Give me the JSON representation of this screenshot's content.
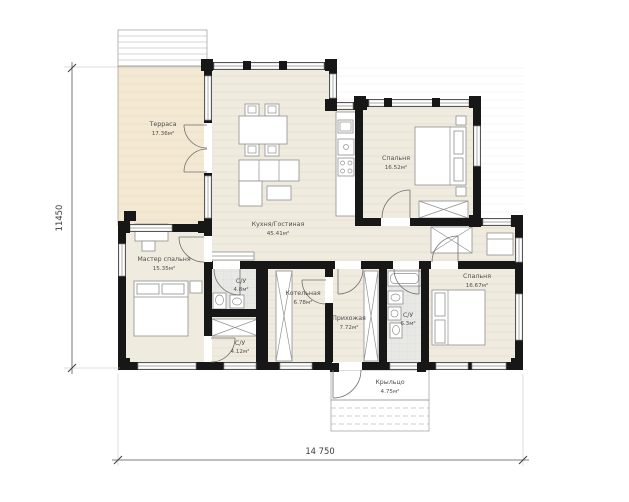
{
  "plan": {
    "title": "single-storey house floor plan",
    "rooms": [
      {
        "id": "terrace",
        "name": "Терраса",
        "area": "17.36м²"
      },
      {
        "id": "kitchen_living",
        "name": "Кухня/Гостиная",
        "area": "45.41м²"
      },
      {
        "id": "bedroom_top",
        "name": "Спальня",
        "area": "16.52м²"
      },
      {
        "id": "master_bedroom",
        "name": "Мастер спальня",
        "area": "15.35м²"
      },
      {
        "id": "bathroom_small",
        "name": "С/У",
        "area": "4.8м²"
      },
      {
        "id": "bathroom_master",
        "name": "С/У",
        "area": "4.12м²"
      },
      {
        "id": "boiler_room",
        "name": "Котельная",
        "area": "6.78м²"
      },
      {
        "id": "hallway",
        "name": "Прихожая",
        "area": "7.72м²"
      },
      {
        "id": "bathroom_main",
        "name": "С/У",
        "area": "6.3м²"
      },
      {
        "id": "bedroom_right",
        "name": "Спальня",
        "area": "16.67м²"
      },
      {
        "id": "porch",
        "name": "Крыльцо",
        "area": "4.75м²"
      }
    ],
    "dimensions": {
      "vertical": "11450",
      "horizontal": "14 750"
    },
    "colors": {
      "wall": "#171717",
      "floor": "#f0ebdf",
      "terrace": "#f3e9d3",
      "tile": "#e8e8e5",
      "label": "#4f4f4f"
    }
  }
}
